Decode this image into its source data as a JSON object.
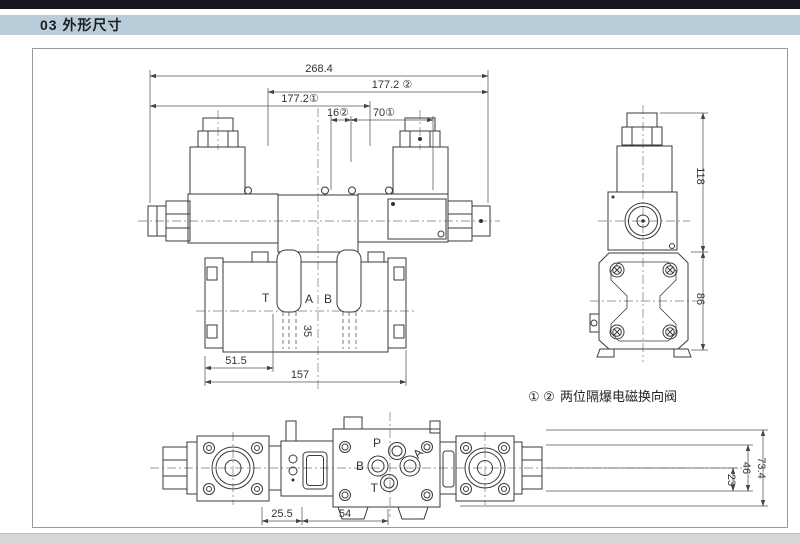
{
  "page": {
    "header": "03 外形尺寸"
  },
  "caption": {
    "refs": "① ②",
    "text": "两位隔爆电磁换向阀"
  },
  "front_view": {
    "dims": {
      "overall": "268.4",
      "len_right": "177.2 ②",
      "len_left": "177.2①",
      "d16": "16②",
      "d70": "70①",
      "d51_5": "51.5",
      "d157": "157",
      "d35": "35"
    },
    "ports": {
      "t": "T",
      "a": "A",
      "b": "B"
    }
  },
  "side_view": {
    "dims": {
      "h_total": "118",
      "h_body": "86"
    }
  },
  "bottom_view": {
    "dims": {
      "d25_5": "25.5",
      "d54": "54",
      "d23": "23",
      "d46": "46",
      "d73_4": "73.4"
    },
    "ports": {
      "p": "P",
      "b": "B",
      "a": "A",
      "t": "T"
    }
  }
}
